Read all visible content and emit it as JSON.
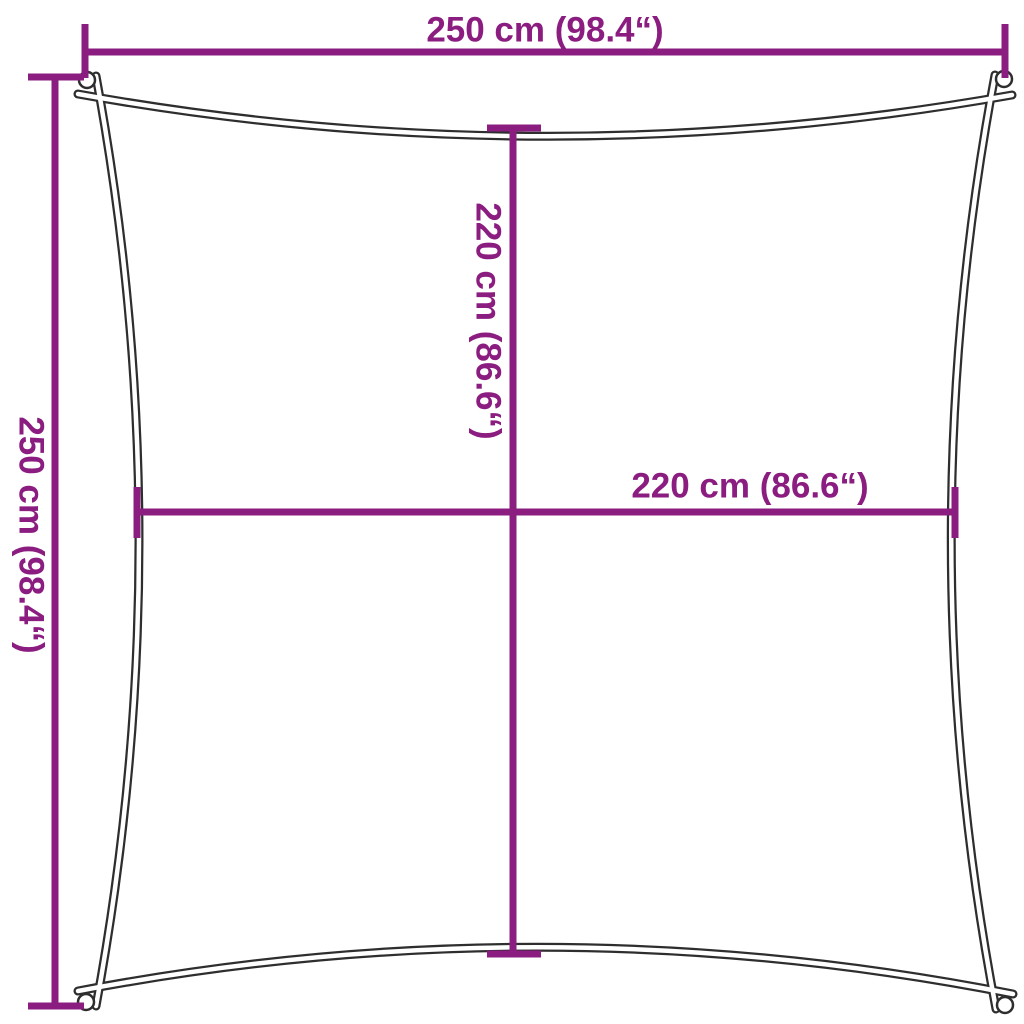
{
  "diagram": {
    "type": "product-dimension-diagram",
    "subject": "square shade sail with concave edges and corner attachment rings",
    "colors": {
      "dimension_line": "#8b1c80",
      "sail_outline": "#2e2e2e",
      "background": "#ffffff"
    },
    "dimensions": {
      "overall_width": {
        "label": "250 cm (98.4“)",
        "value_cm": 250,
        "value_in": 98.4
      },
      "overall_height": {
        "label": "250 cm (98.4“)",
        "value_cm": 250,
        "value_in": 98.4
      },
      "inner_height": {
        "label": "220 cm (86.6“)",
        "value_cm": 220,
        "value_in": 86.6
      },
      "inner_width": {
        "label": "220 cm (86.6“)",
        "value_cm": 220,
        "value_in": 86.6
      }
    }
  }
}
